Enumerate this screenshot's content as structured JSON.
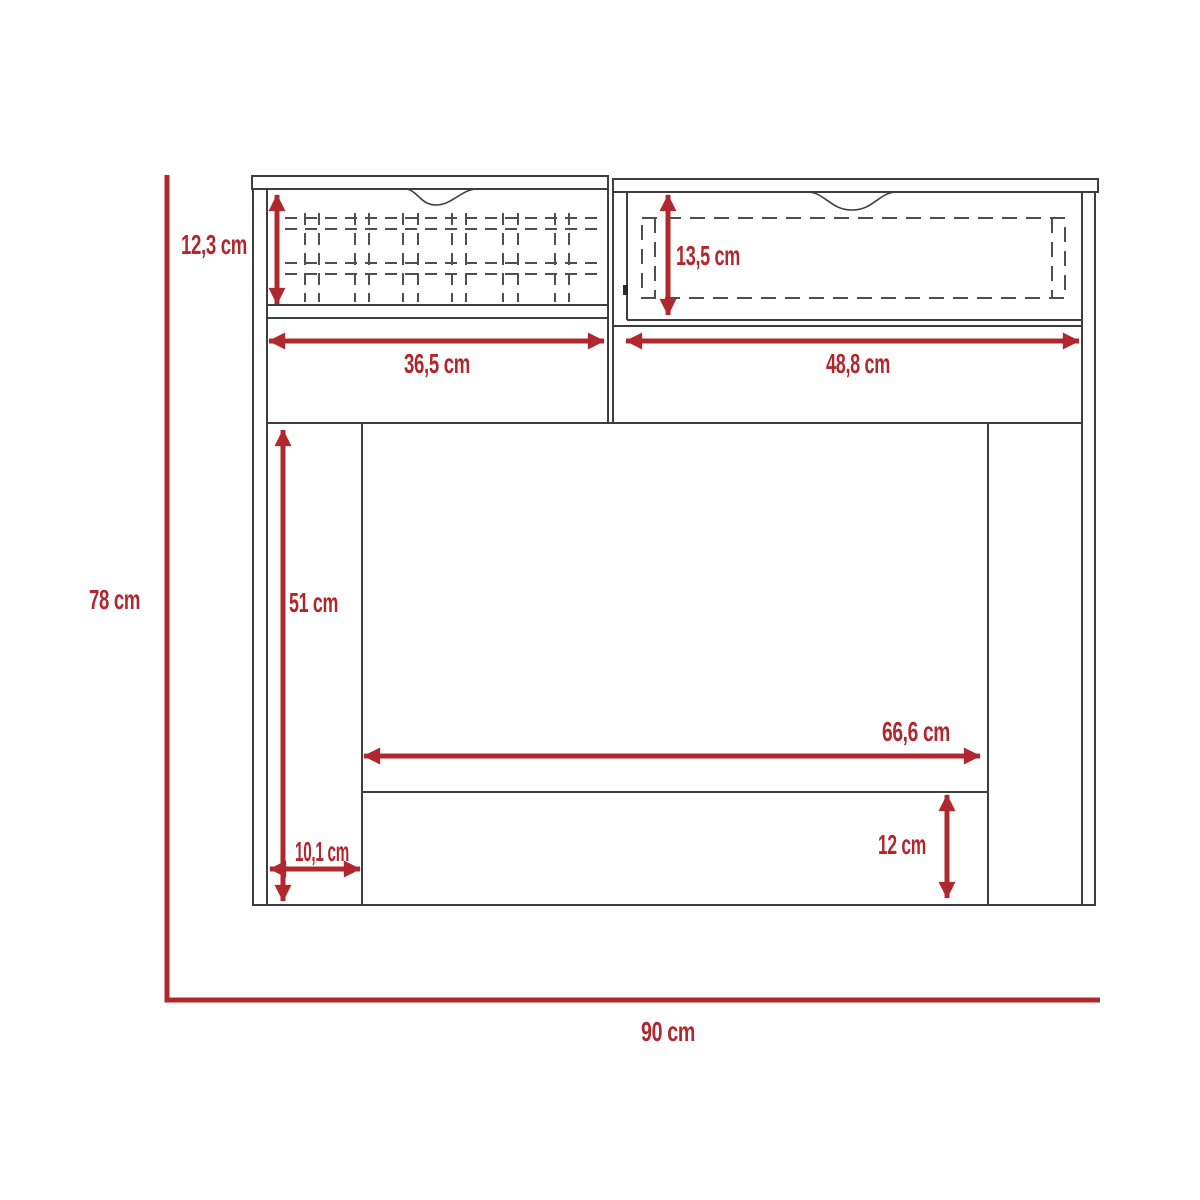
{
  "diagram": {
    "type": "furniture-dimension-drawing",
    "subject": "two-drawer desk front elevation with measurements",
    "unit": "cm",
    "colors": {
      "dimension_red": "#B0282D",
      "outline_gray": "#3E3E3E",
      "dashed_gray": "#4F4F4F",
      "background": "#FFFFFF"
    },
    "dimensions": {
      "left_drawer_height": "12,3 cm",
      "right_drawer_height": "13,5 cm",
      "left_drawer_width": "36,5 cm",
      "right_drawer_width": "48,8 cm",
      "knee_space_height": "51 cm",
      "knee_space_width": "66,6 cm",
      "side_panel_width": "10,1 cm",
      "stretcher_height": "12 cm",
      "overall_height": "78 cm",
      "overall_width": "90 cm"
    }
  }
}
